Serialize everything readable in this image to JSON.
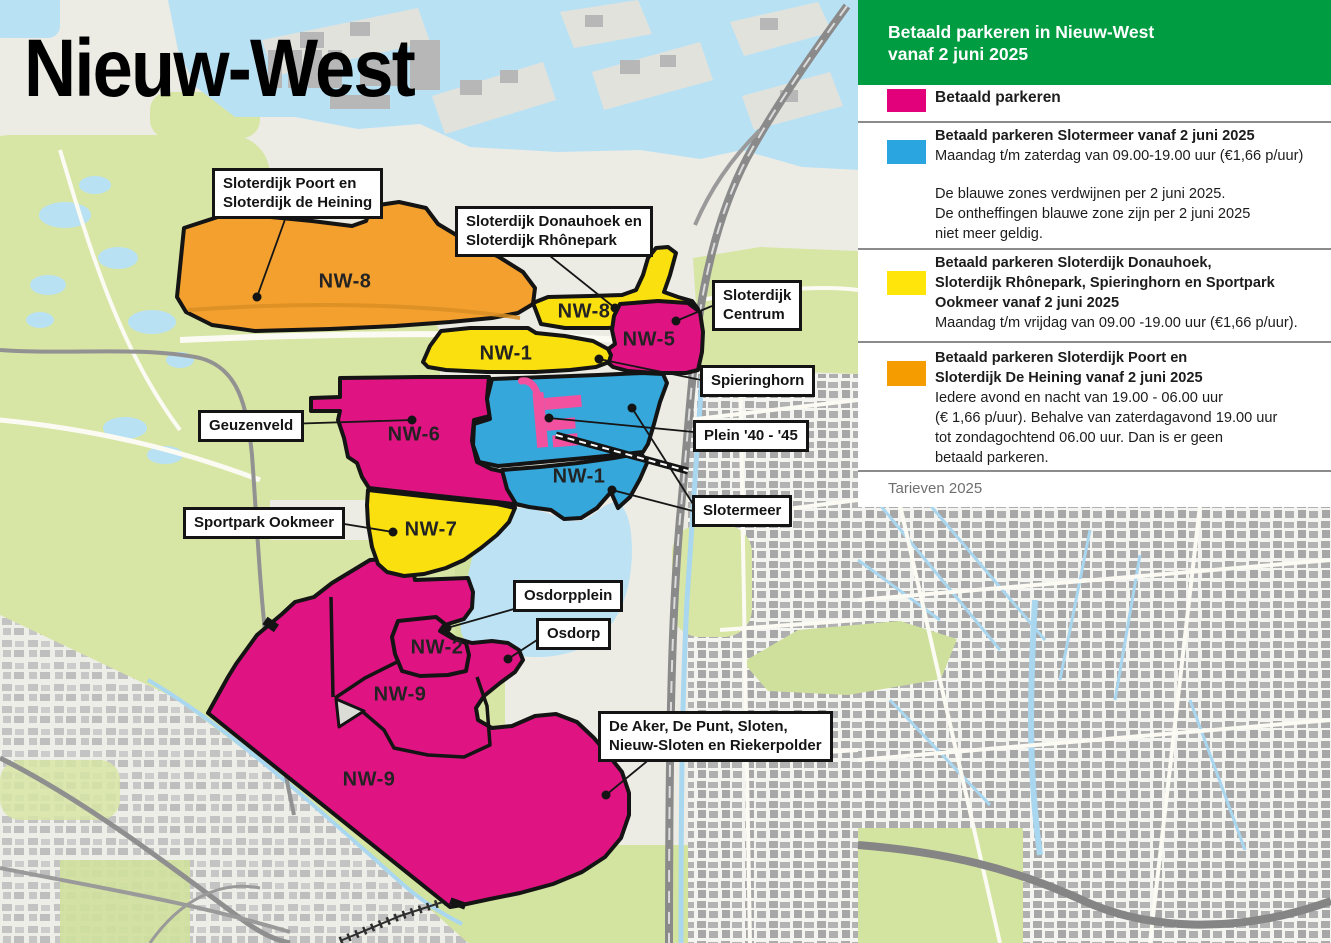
{
  "title": "Nieuw-West",
  "legend": {
    "header": "Betaald parkeren in Nieuw-West\nvanaf 2 juni 2025",
    "items": [
      {
        "swatch_color": "#E2007B",
        "title": "Betaald parkeren"
      },
      {
        "swatch_color": "#2BA5DF",
        "title": "Betaald parkeren Slotermeer vanaf 2 juni 2025",
        "schedule": "Maandag t/m zaterdag van 09.00-19.00 uur (€1,66 p/uur)",
        "note": "De blauwe zones verdwijnen per 2 juni 2025.\nDe ontheffingen blauwe zone zijn per 2 juni 2025\nniet meer geldig."
      },
      {
        "swatch_color": "#FFE50A",
        "title": "Betaald parkeren Sloterdijk Donauhoek,\nSloterdijk Rhônepark, Spieringhorn en Sportpark\nOokmeer vanaf 2 juni 2025",
        "schedule": "Maandag t/m vrijdag van 09.00 -19.00 uur (€1,66 p/uur)."
      },
      {
        "swatch_color": "#F59C00",
        "title": "Betaald parkeren Sloterdijk Poort en\nSloterdijk De Heining vanaf 2 juni 2025",
        "schedule": "Iedere avond en nacht van 19.00 - 06.00 uur\n(€ 1,66 p/uur). Behalve van zaterdagavond 19.00 uur\ntot zondagochtend 06.00 uur. Dan is er geen\nbetaald parkeren."
      }
    ],
    "footer": "Tarieven 2025"
  },
  "map": {
    "zones": [
      {
        "id": "nw8-orange",
        "label": "NW-8"
      },
      {
        "id": "nw8-yellow",
        "label": "NW-8"
      },
      {
        "id": "nw1-yellow",
        "label": "NW-1"
      },
      {
        "id": "nw5",
        "label": "NW-5"
      },
      {
        "id": "nw6",
        "label": "NW-6"
      },
      {
        "id": "nw1-blue",
        "label": "NW-1"
      },
      {
        "id": "nw7",
        "label": "NW-7"
      },
      {
        "id": "nw2",
        "label": "NW-2"
      },
      {
        "id": "nw9-north",
        "label": "NW-9"
      },
      {
        "id": "nw9-south",
        "label": "NW-9"
      }
    ],
    "callouts": [
      {
        "id": "sloterdijk-poort",
        "text": "Sloterdijk Poort en\nSloterdijk de Heining"
      },
      {
        "id": "sloterdijk-donauhoek",
        "text": "Sloterdijk Donauhoek en\nSloterdijk Rhônepark"
      },
      {
        "id": "sloterdijk-centrum",
        "text": "Sloterdijk\nCentrum"
      },
      {
        "id": "spieringhorn",
        "text": "Spieringhorn"
      },
      {
        "id": "geuzenveld",
        "text": "Geuzenveld"
      },
      {
        "id": "plein-40-45",
        "text": "Plein '40 - '45"
      },
      {
        "id": "slotermeer",
        "text": "Slotermeer"
      },
      {
        "id": "sportpark-ookmeer",
        "text": "Sportpark Ookmeer"
      },
      {
        "id": "osdorpplein",
        "text": "Osdorpplein"
      },
      {
        "id": "osdorp",
        "text": "Osdorp"
      },
      {
        "id": "de-aker",
        "text": "De Aker, De Punt, Sloten,\nNieuw-Sloten en Riekerpolder"
      }
    ]
  },
  "colors": {
    "header_green": "#009C41",
    "zone_pink": "#E01383",
    "zone_blue": "#35A7DB",
    "zone_yellow": "#FAE00E",
    "zone_orange": "#F3A02F",
    "plein_pink": "#F2519F",
    "water": "#B9E1F4",
    "park_green": "#D7E5A5",
    "map_background": "#ECECE5"
  }
}
